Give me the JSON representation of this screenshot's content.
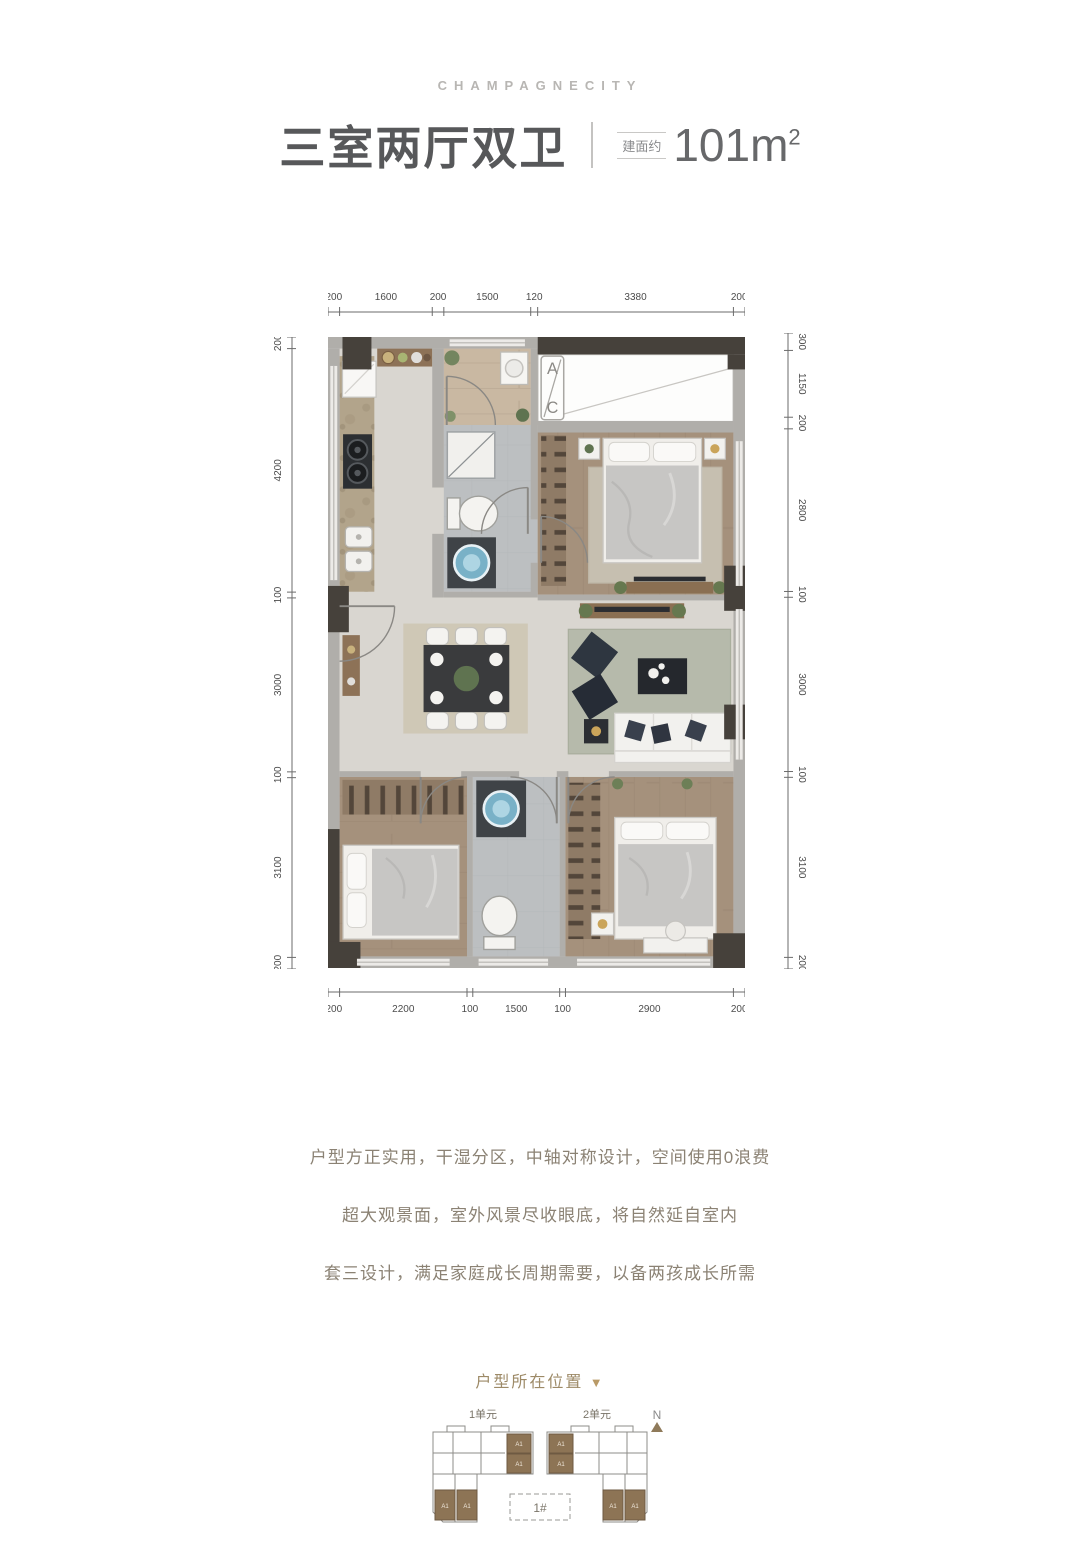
{
  "brand": "CHAMPAGNECITY",
  "title": {
    "name": "三室两厅双卫",
    "area_label": "建面约",
    "area_value": "101m",
    "area_sup": "2"
  },
  "plan": {
    "dims": {
      "top": [
        "200",
        "1600",
        "200",
        "1500",
        "120",
        "3380",
        "200"
      ],
      "bottom": [
        "200",
        "2200",
        "100",
        "1500",
        "100",
        "2900",
        "200"
      ],
      "left": [
        "200",
        "4200",
        "100",
        "3000",
        "100",
        "3100",
        "200"
      ],
      "right": [
        "300",
        "1150",
        "200",
        "2800",
        "100",
        "3000",
        "100",
        "3100",
        "200"
      ]
    },
    "ac_label_top": "A",
    "ac_label_bottom": "C"
  },
  "description": {
    "line1": "户型方正实用，干湿分区，中轴对称设计，空间使用0浪费",
    "line2": "超大观景面，室外风景尽收眼底，将自然延自室内",
    "line3": "套三设计，满足家庭成长周期需要，以备两孩成长所需"
  },
  "locator": {
    "title": "户型所在位置",
    "arrow": "▼",
    "unit1": "1单元",
    "unit2": "2单元",
    "north": "N",
    "building": "1#",
    "cell_label": "A1"
  },
  "colors": {
    "accent": "#9d8a67",
    "wall-dark": "#46413b",
    "wall-light": "#b0aeaa",
    "wood": "#a5917c",
    "tile": "#bcbfc1",
    "basin-blue": "#79b1c7"
  }
}
